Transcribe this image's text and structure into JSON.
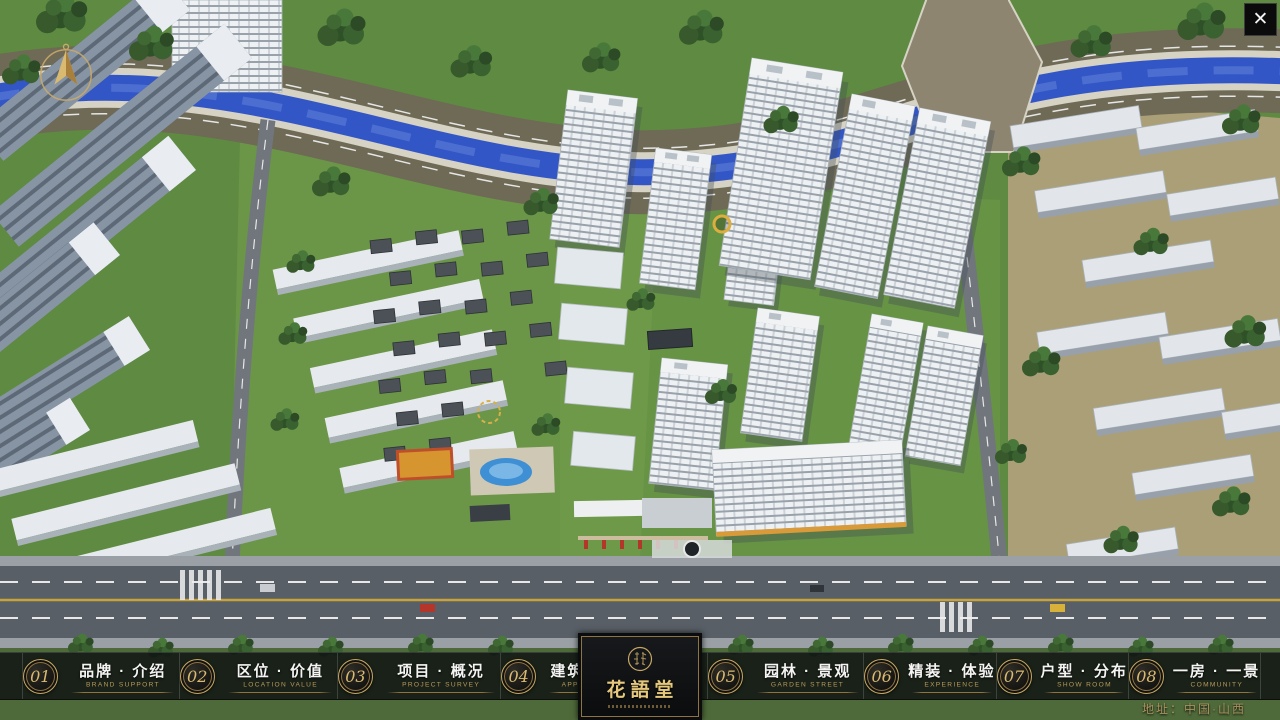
{
  "window": {
    "close_glyph": "✕"
  },
  "logo": {
    "name": "花語堂"
  },
  "nav": {
    "items": [
      {
        "num": "01",
        "label": "品牌 · 介绍",
        "en": "BRAND SUPPORT"
      },
      {
        "num": "02",
        "label": "区位 · 价值",
        "en": "LOCATION VALUE"
      },
      {
        "num": "03",
        "label": "项目 · 概况",
        "en": "PROJECT SURVEY"
      },
      {
        "num": "04",
        "label": "建筑 · 鉴赏",
        "en": "APPRECIATION"
      },
      {
        "num": "05",
        "label": "园林 · 景观",
        "en": "GARDEN STREET"
      },
      {
        "num": "06",
        "label": "精装 · 体验",
        "en": "EXPERIENCE"
      },
      {
        "num": "07",
        "label": "户型 · 分布",
        "en": "SHOW ROOM"
      },
      {
        "num": "08",
        "label": "一房 · 一景",
        "en": "COMMUNITY"
      }
    ]
  },
  "footer": {
    "address": "地址：中国·山西"
  },
  "icons": {
    "close": "close-icon",
    "compass": "compass-north-icon",
    "seal": "logo-seal-icon"
  },
  "colors": {
    "gold": "#c7a863",
    "nav_bg": "rgba(10,13,16,0.78)",
    "river": "#3356c6",
    "lawn": "#5e8b41",
    "road": "#585f66",
    "tower_white": "#eef1f3"
  }
}
